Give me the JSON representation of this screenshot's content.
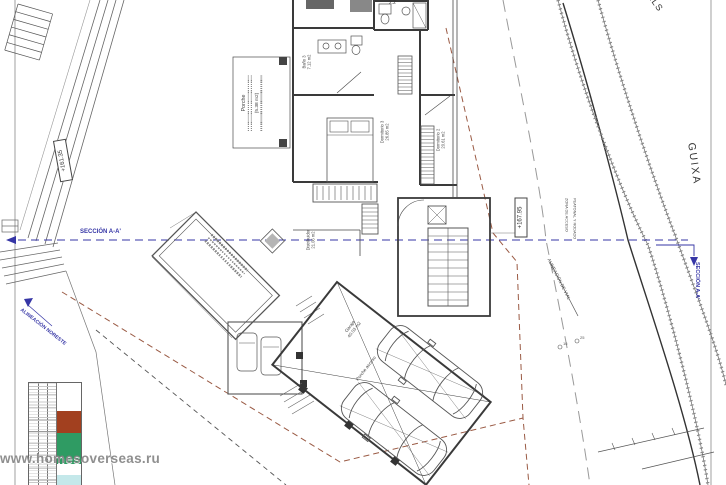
{
  "streets": {
    "right": "GUIXA",
    "top_right": "ELS"
  },
  "levels": {
    "street_upper": "+161.35",
    "plan": "+167.95"
  },
  "section": {
    "left": "SECCIÓN A-A'",
    "right": "SECCIÓN A-A'"
  },
  "notes": {
    "alignment": "ALINEACIÓN NORESTE",
    "vial": "ALINEACIÓN DE VIAL",
    "access_line1": "ZONA DE ACCESO",
    "access_line2": "PEATONAL Y RODADO"
  },
  "rooms": {
    "bano3": {
      "name": "Baño 3",
      "area": "7.12 m2"
    },
    "dorm3": {
      "name": "Dormitorio 3",
      "area": "26.85 m2"
    },
    "dorm2": {
      "name": "Dormitorio 2",
      "area": "20.61 m2"
    },
    "distribuidor": {
      "name": "Distribuidor",
      "area": "21.06 m2"
    },
    "porche": {
      "name": "Porche",
      "area": "(5.38 m2)"
    },
    "garaje": {
      "name": "Garaje",
      "area": "40.03 m2"
    },
    "porche_acceso": {
      "name": "Porche acceso"
    },
    "bano2": {
      "area": "2.2"
    }
  },
  "survey_points": {
    "p1": "16",
    "p2": "25"
  },
  "legend": {
    "colors": {
      "red": "#a2401f",
      "green": "#2f9b63",
      "cyan": "#c4e8ea"
    }
  },
  "watermark": "www.homesoverseas.ru",
  "palette": {
    "section_blue": "#3636a6",
    "setback_red": "#9a5a44",
    "line": "#3f3f3f"
  }
}
